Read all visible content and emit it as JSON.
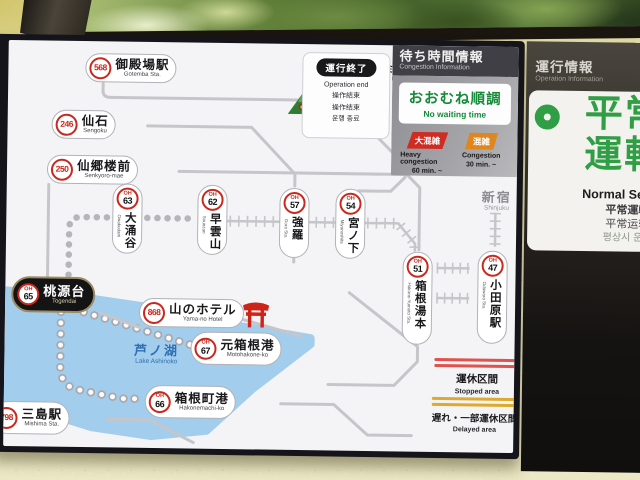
{
  "map": {
    "stations": {
      "gotemba": {
        "badge": "568",
        "jp": "御殿場駅",
        "en": "Gotemba Sta."
      },
      "outlets": {
        "badge": "563",
        "jp_top": "御殿場",
        "jp": "プレミアム・アウトレット",
        "en": "Gotemba Premium Outlets"
      },
      "sengoku": {
        "badge": "246",
        "jp": "仙石",
        "en": "Sengoku"
      },
      "senkyoro": {
        "badge": "250",
        "jp": "仙郷楼前",
        "en": "Senkyoro-mae"
      },
      "owakudani": {
        "badge_prefix": "OH",
        "badge": "63",
        "jp": "大涌谷",
        "en": "Owakudani"
      },
      "sounzan": {
        "badge_prefix": "OH",
        "badge": "62",
        "jp": "早雲山",
        "en": "Sounzan"
      },
      "gora": {
        "badge_prefix": "OH",
        "badge": "57",
        "jp": "強羅",
        "en": "Gora Sta."
      },
      "miyanoshita": {
        "badge_prefix": "OH",
        "badge": "54",
        "jp": "宮ノ下",
        "en": "Miyanoshita"
      },
      "kowakien": {
        "badge": "137",
        "jp": "小涌園",
        "en": "Kowaki-en"
      },
      "yumoto": {
        "badge_prefix": "OH",
        "badge": "51",
        "jp": "箱根湯本",
        "en": "Hakone-Yumoto Sta."
      },
      "odawara": {
        "badge_prefix": "OH",
        "badge": "47",
        "jp": "小田原駅",
        "en": "Odawara Sta."
      },
      "shinjuku": {
        "jp": "新宿",
        "en": "Shinjuku"
      },
      "togendai": {
        "badge_prefix": "OH",
        "badge": "65",
        "jp": "桃源台",
        "en": "Togendai"
      },
      "yamanohotel": {
        "badge": "868",
        "jp": "山のホテル",
        "en": "Yama-no Hotel"
      },
      "motohakone": {
        "badge_prefix": "OH",
        "badge": "67",
        "jp": "元箱根港",
        "en": "Motohakone-ko"
      },
      "hakonemachi": {
        "badge_prefix": "OH",
        "badge": "66",
        "jp": "箱根町港",
        "en": "Hakonemachi-ko"
      },
      "mishima": {
        "badge": "798",
        "jp": "三島駅",
        "en": "Mishima Sta."
      }
    },
    "lake": {
      "jp": "芦ノ湖",
      "en": "Lake Ashinoko"
    },
    "operation_end_legend": {
      "badge": "運行終了",
      "lines": [
        "Operation end",
        "操作結束",
        "操作结束",
        "운행 종료"
      ]
    },
    "line_legend": {
      "stopped": {
        "jp": "運休区間",
        "en": "Stopped area"
      },
      "delayed": {
        "jp": "遅れ・一部運休区間",
        "en": "Delayed area"
      }
    }
  },
  "congestion_panel": {
    "title_jp": "待ち時間情報",
    "title_en": "Congestion Information",
    "status_jp": "おおむね順調",
    "status_en": "No waiting time",
    "heavy": {
      "label": "大混雑",
      "line1": "Heavy congestion",
      "line2": "60 min. ~"
    },
    "mid": {
      "label": "混雑",
      "line1": "Congestion",
      "line2": "30 min. ~"
    }
  },
  "operation_panel": {
    "title_jp": "運行情報",
    "title_en": "Operation Information",
    "status_big": "平常\n運転",
    "sub_en": "Normal Service",
    "sub_zh1": "平常運転",
    "sub_zh2": "平常运转",
    "sub_ko": "평상시 운행"
  },
  "colors": {
    "accent_green": "#2f9e44",
    "status_green": "#178a3a",
    "badge_red": "#c8281e",
    "heavy_red": "#cf2d24",
    "congestion_orange": "#e0861f",
    "lake_blue": "#a2cdec",
    "stopped_red": "#e2524c",
    "delayed_gold": "#ddaa30"
  }
}
